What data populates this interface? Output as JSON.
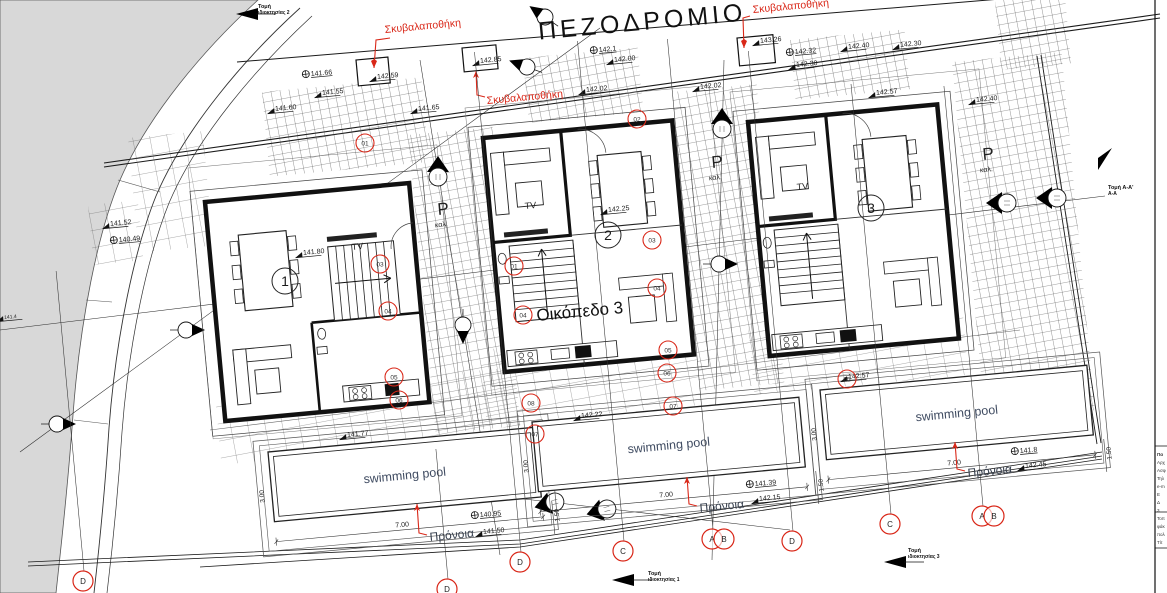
{
  "street_label": "ΠΕΖΟΔΡΟΜΙΟ",
  "plot_label": "Οικόπεδο 3",
  "tv_label": "TV",
  "pool_label": "swimming pool",
  "colors": {
    "red": "#d92718",
    "ink": "#1a1a1a",
    "road_gray": "#d8d8d8",
    "pool_text": "#3f4b61"
  },
  "houses": [
    {
      "number": "1",
      "variant": "B",
      "x": 205,
      "y": 202,
      "num_x": 285,
      "num_y": 281,
      "tv_x": 352,
      "tv_y": 250
    },
    {
      "number": "2",
      "variant": "A",
      "x": 483,
      "y": 138,
      "num_x": 608,
      "num_y": 235,
      "tv_x": 525,
      "tv_y": 209
    },
    {
      "number": "3",
      "variant": "A",
      "x": 748,
      "y": 122,
      "num_x": 871,
      "num_y": 208,
      "tv_x": 797,
      "tv_y": 190
    }
  ],
  "parking": {
    "label": "Ρ",
    "sub": "καλ.",
    "positions": [
      {
        "x": 438,
        "y": 215
      },
      {
        "x": 712,
        "y": 168
      },
      {
        "x": 983,
        "y": 160
      }
    ]
  },
  "pools": [
    {
      "x": 268,
      "y": 452,
      "dim_length": "7.00",
      "dim_width": "3.00",
      "dim_offset": "1.50"
    },
    {
      "x": 532,
      "y": 422,
      "dim_length": "7.00",
      "dim_width": "3.00",
      "dim_offset": "1.50"
    },
    {
      "x": 820,
      "y": 390,
      "dim_length": "7.00",
      "dim_width": "3.00",
      "dim_offset": "1.50"
    }
  ],
  "garbage_labels": [
    {
      "text": "Σκυβαλαποθήκη",
      "x": 385,
      "y": 33,
      "arrow": [
        [
          390,
          38
        ],
        [
          376,
          40
        ],
        [
          374,
          68
        ]
      ]
    },
    {
      "text": "Σκυβαλαποθήκη",
      "x": 487,
      "y": 104,
      "arrow": [
        [
          485,
          97
        ],
        [
          477,
          95
        ],
        [
          476,
          71
        ]
      ]
    },
    {
      "text": "Σκυβαλαποθήκη",
      "x": 753,
      "y": 13,
      "arrow": [
        [
          750,
          16
        ],
        [
          743,
          18
        ],
        [
          744,
          48
        ]
      ]
    }
  ],
  "pronoia_labels": [
    {
      "text": "Πρόνοια",
      "x": 430,
      "y": 541,
      "arrow": [
        [
          427,
          535
        ],
        [
          419,
          533
        ],
        [
          417,
          504
        ]
      ]
    },
    {
      "text": "Πρόνοια",
      "x": 700,
      "y": 512,
      "arrow": [
        [
          697,
          506
        ],
        [
          689,
          504
        ],
        [
          687,
          477
        ]
      ]
    },
    {
      "text": "Πρόνοια",
      "x": 968,
      "y": 477,
      "arrow": [
        [
          965,
          471
        ],
        [
          957,
          469
        ],
        [
          955,
          442
        ]
      ]
    }
  ],
  "elevations": [
    {
      "t": "141.66",
      "x": 313,
      "y": 76,
      "b": 1
    },
    {
      "t": "141.55",
      "x": 322,
      "y": 92
    },
    {
      "t": "141.60",
      "x": 275,
      "y": 108
    },
    {
      "t": "141.65",
      "x": 418,
      "y": 108
    },
    {
      "t": "142.59",
      "x": 377,
      "y": 76
    },
    {
      "t": "142.85",
      "x": 480,
      "y": 60
    },
    {
      "t": "142.1",
      "x": 601,
      "y": 52,
      "b": 1
    },
    {
      "t": "142.00",
      "x": 614,
      "y": 59
    },
    {
      "t": "142.02",
      "x": 586,
      "y": 89
    },
    {
      "t": "142.02",
      "x": 700,
      "y": 86
    },
    {
      "t": "143.26",
      "x": 760,
      "y": 40
    },
    {
      "t": "142.32",
      "x": 797,
      "y": 54,
      "b": 1
    },
    {
      "t": "142.30",
      "x": 796,
      "y": 64
    },
    {
      "t": "142.40",
      "x": 848,
      "y": 46
    },
    {
      "t": "142.30",
      "x": 900,
      "y": 44
    },
    {
      "t": "142.57",
      "x": 876,
      "y": 92
    },
    {
      "t": "142.40",
      "x": 976,
      "y": 99
    },
    {
      "t": "141.52",
      "x": 110,
      "y": 223
    },
    {
      "t": "140.49",
      "x": 121,
      "y": 242,
      "b": 1
    },
    {
      "t": "141.80",
      "x": 303,
      "y": 252
    },
    {
      "t": "142.25",
      "x": 608,
      "y": 209
    },
    {
      "t": "141.77",
      "x": 347,
      "y": 434
    },
    {
      "t": "142.22",
      "x": 581,
      "y": 415
    },
    {
      "t": "140.95",
      "x": 482,
      "y": 517,
      "b": 1
    },
    {
      "t": "141.50",
      "x": 483,
      "y": 531
    },
    {
      "t": "141.39",
      "x": 757,
      "y": 486,
      "b": 1
    },
    {
      "t": "142.15",
      "x": 759,
      "y": 498
    },
    {
      "t": "142.57",
      "x": 848,
      "y": 376
    },
    {
      "t": "141.8",
      "x": 1022,
      "y": 453,
      "b": 1
    },
    {
      "t": "142.45",
      "x": 1025,
      "y": 465
    },
    {
      "t": "141.4",
      "x": 4,
      "y": 316,
      "s": 5
    }
  ],
  "ref_circles": [
    {
      "n": "01",
      "x": 365,
      "y": 143
    },
    {
      "n": "02",
      "x": 637,
      "y": 119
    },
    {
      "n": "03",
      "x": 380,
      "y": 264
    },
    {
      "n": "04",
      "x": 388,
      "y": 311
    },
    {
      "n": "05",
      "x": 394,
      "y": 377
    },
    {
      "n": "06",
      "x": 399,
      "y": 400
    },
    {
      "n": "01",
      "x": 514,
      "y": 266
    },
    {
      "n": "03",
      "x": 652,
      "y": 240
    },
    {
      "n": "04",
      "x": 657,
      "y": 288
    },
    {
      "n": "04",
      "x": 523,
      "y": 315
    },
    {
      "n": "05",
      "x": 668,
      "y": 350
    },
    {
      "n": "06",
      "x": 667,
      "y": 373
    },
    {
      "n": "07",
      "x": 673,
      "y": 406
    },
    {
      "n": "08",
      "x": 531,
      "y": 403
    },
    {
      "n": "07",
      "x": 535,
      "y": 434
    },
    {
      "n": "05",
      "x": 847,
      "y": 379
    }
  ],
  "grid_bubbles": [
    {
      "letter": "D",
      "x": 83,
      "y": 581,
      "line": 300
    },
    {
      "letter": "D",
      "x": 447,
      "y": 589,
      "line": 130
    },
    {
      "letter": "D",
      "x": 520,
      "y": 562,
      "line": 500
    },
    {
      "letter": "C",
      "x": 623,
      "y": 551,
      "line": 500
    },
    {
      "letter": "A",
      "x": 712,
      "y": 539,
      "line": 490
    },
    {
      "letter": "B",
      "x": 724,
      "y": 539,
      "line": 0
    },
    {
      "letter": "D",
      "x": 792,
      "y": 541,
      "line": 480
    },
    {
      "letter": "C",
      "x": 890,
      "y": 524,
      "line": 430
    },
    {
      "letter": "A",
      "x": 982,
      "y": 516,
      "line": 420
    },
    {
      "letter": "B",
      "x": 994,
      "y": 516,
      "line": 0
    }
  ],
  "sections": [
    {
      "line1": "Τομή",
      "line2": "ιδιοκτησίας 2",
      "x": 258,
      "y": 8
    },
    {
      "line1": "Τομή",
      "line2": "ιδιοκτησίας 1",
      "x": 648,
      "y": 575
    },
    {
      "line1": "Τομή",
      "line2": "ιδιοκτησίας 3",
      "x": 908,
      "y": 552
    },
    {
      "line1": "Τομή Α-Α'",
      "line2": "Α-Α",
      "x": 1108,
      "y": 189
    }
  ],
  "title_block": {
    "fragments": [
      "Πα",
      "Αρχ",
      "Ασφ",
      "Τηλ",
      "e-m",
      "Ε",
      "Δ",
      "3",
      "Τοπ",
      "φάκ",
      "πολ",
      "Τίτ"
    ]
  }
}
